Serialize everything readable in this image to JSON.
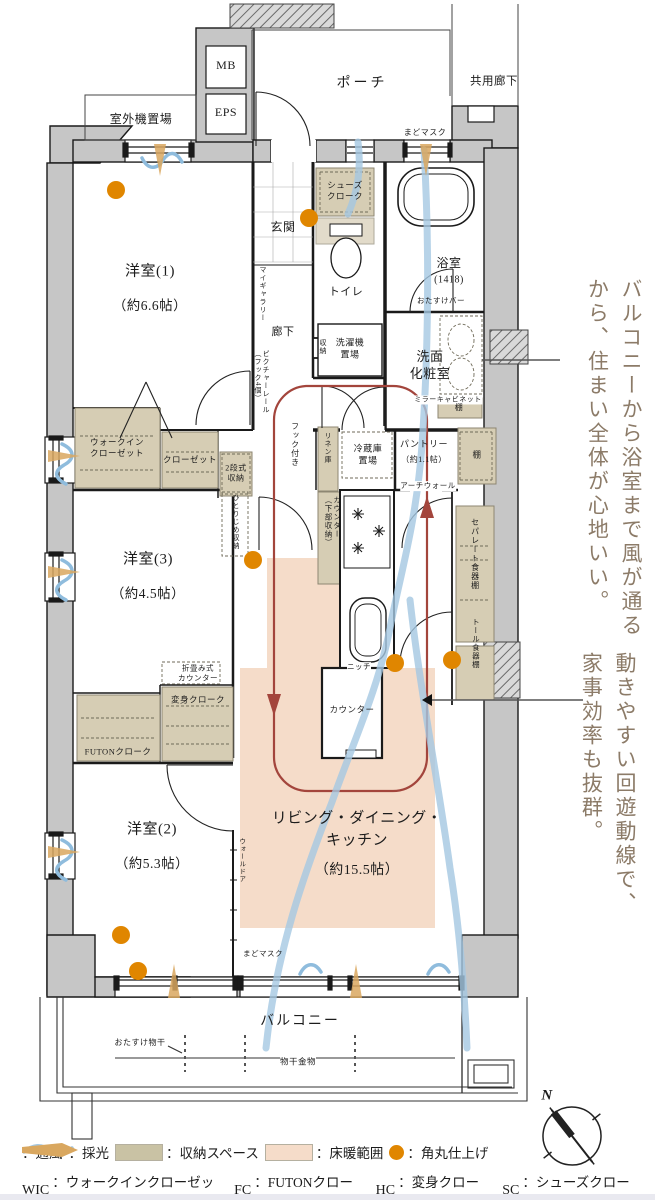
{
  "colors": {
    "vent_blue": "#a5c8e2",
    "daylight_tan": "#d9a75f",
    "storage_olive": "#c9c2a4",
    "heating_pink": "#f5dcc9",
    "corner_orange": "#e08600",
    "circulation_red": "#a3453c",
    "wall_gray": "#c6c6c6",
    "annotation_brown": "#8c7b68"
  },
  "plan": {
    "rooms": {
      "mb": "MB",
      "eps": "EPS",
      "outdoor_unit": "室外機置場",
      "porch": "ポーチ",
      "shared_corridor": "共用廊下",
      "entrance": "玄関",
      "hallway": "廊下",
      "toilet": "トイレ",
      "bath_name": "浴室",
      "bath_size": "(1418)",
      "washroom": "洗面\n化粧室",
      "bedroom1_name": "洋室(1)",
      "bedroom1_size": "（約6.6帖）",
      "bedroom3_name": "洋室(3)",
      "bedroom3_size": "（約4.5帖）",
      "bedroom2_name": "洋室(2)",
      "bedroom2_size": "（約5.3帖）",
      "ldk_name": "リビング・ダイニング・\nキッチン",
      "ldk_size": "（約15.5帖）",
      "balcony": "バルコニー"
    },
    "features": {
      "window_mask_top": "まどマスク",
      "window_mask_bottom": "まどマスク",
      "shoes_cloak": "シューズ\nクローク",
      "helper_bar": "おたすけバー",
      "washer": "洗濯機\n置場",
      "mirror_cabinet": "ミラーキャビネット",
      "shelf1": "棚",
      "shelf2": "棚",
      "storage": "収納",
      "my_gallery": "マイギャラリー",
      "picture_rail": "ピクチャーレール\n（フック4個）",
      "hook": "フック付き",
      "linen": "リネン庫",
      "fridge": "冷蔵庫\n置場",
      "pantry_name": "パントリー",
      "pantry_size": "（約1.1帖）",
      "arch_wall": "アーチウォール",
      "counter_storage": "カウンター\n（下部収納）",
      "separate_cupboard": "セパレート食器棚",
      "tall_cupboard": "トール食器棚",
      "niche": "ニッチ",
      "counter": "カウンター",
      "hitorijime": "ひとりじめ収納",
      "two_tier": "2段式\n収納",
      "wic": "ウォークイン\nクローゼット",
      "closet": "クローゼット",
      "folding_counter": "折畳み式\nカウンター",
      "henshin_cloak": "変身クローク",
      "futon_cloak": "FUTONクローク",
      "wall_door": "ウォールドア",
      "drying_helper": "おたすけ物干",
      "drying_hardware": "物干金物"
    }
  },
  "annotations": {
    "comfort": "バルコニーから浴室まで風が通るから、住まい全体が心地いい。",
    "flow": "動きやすい回遊動線で、家事効率も抜群。"
  },
  "legend": {
    "ventilation": "：通風",
    "daylight": "：採光",
    "storage_space": "：収納スペース",
    "floor_heating": "：床暖範囲",
    "rounded_corner": "：角丸仕上げ",
    "wic_abbr": "WIC",
    "wic_label": "：ウォークインクローゼット",
    "fc_abbr": "FC",
    "fc_label": "：FUTONクローク",
    "hc_abbr": "HC",
    "hc_label": "：変身クローク",
    "sc_abbr": "SC",
    "sc_label": "：シューズクローク"
  },
  "compass": {
    "north": "N"
  }
}
